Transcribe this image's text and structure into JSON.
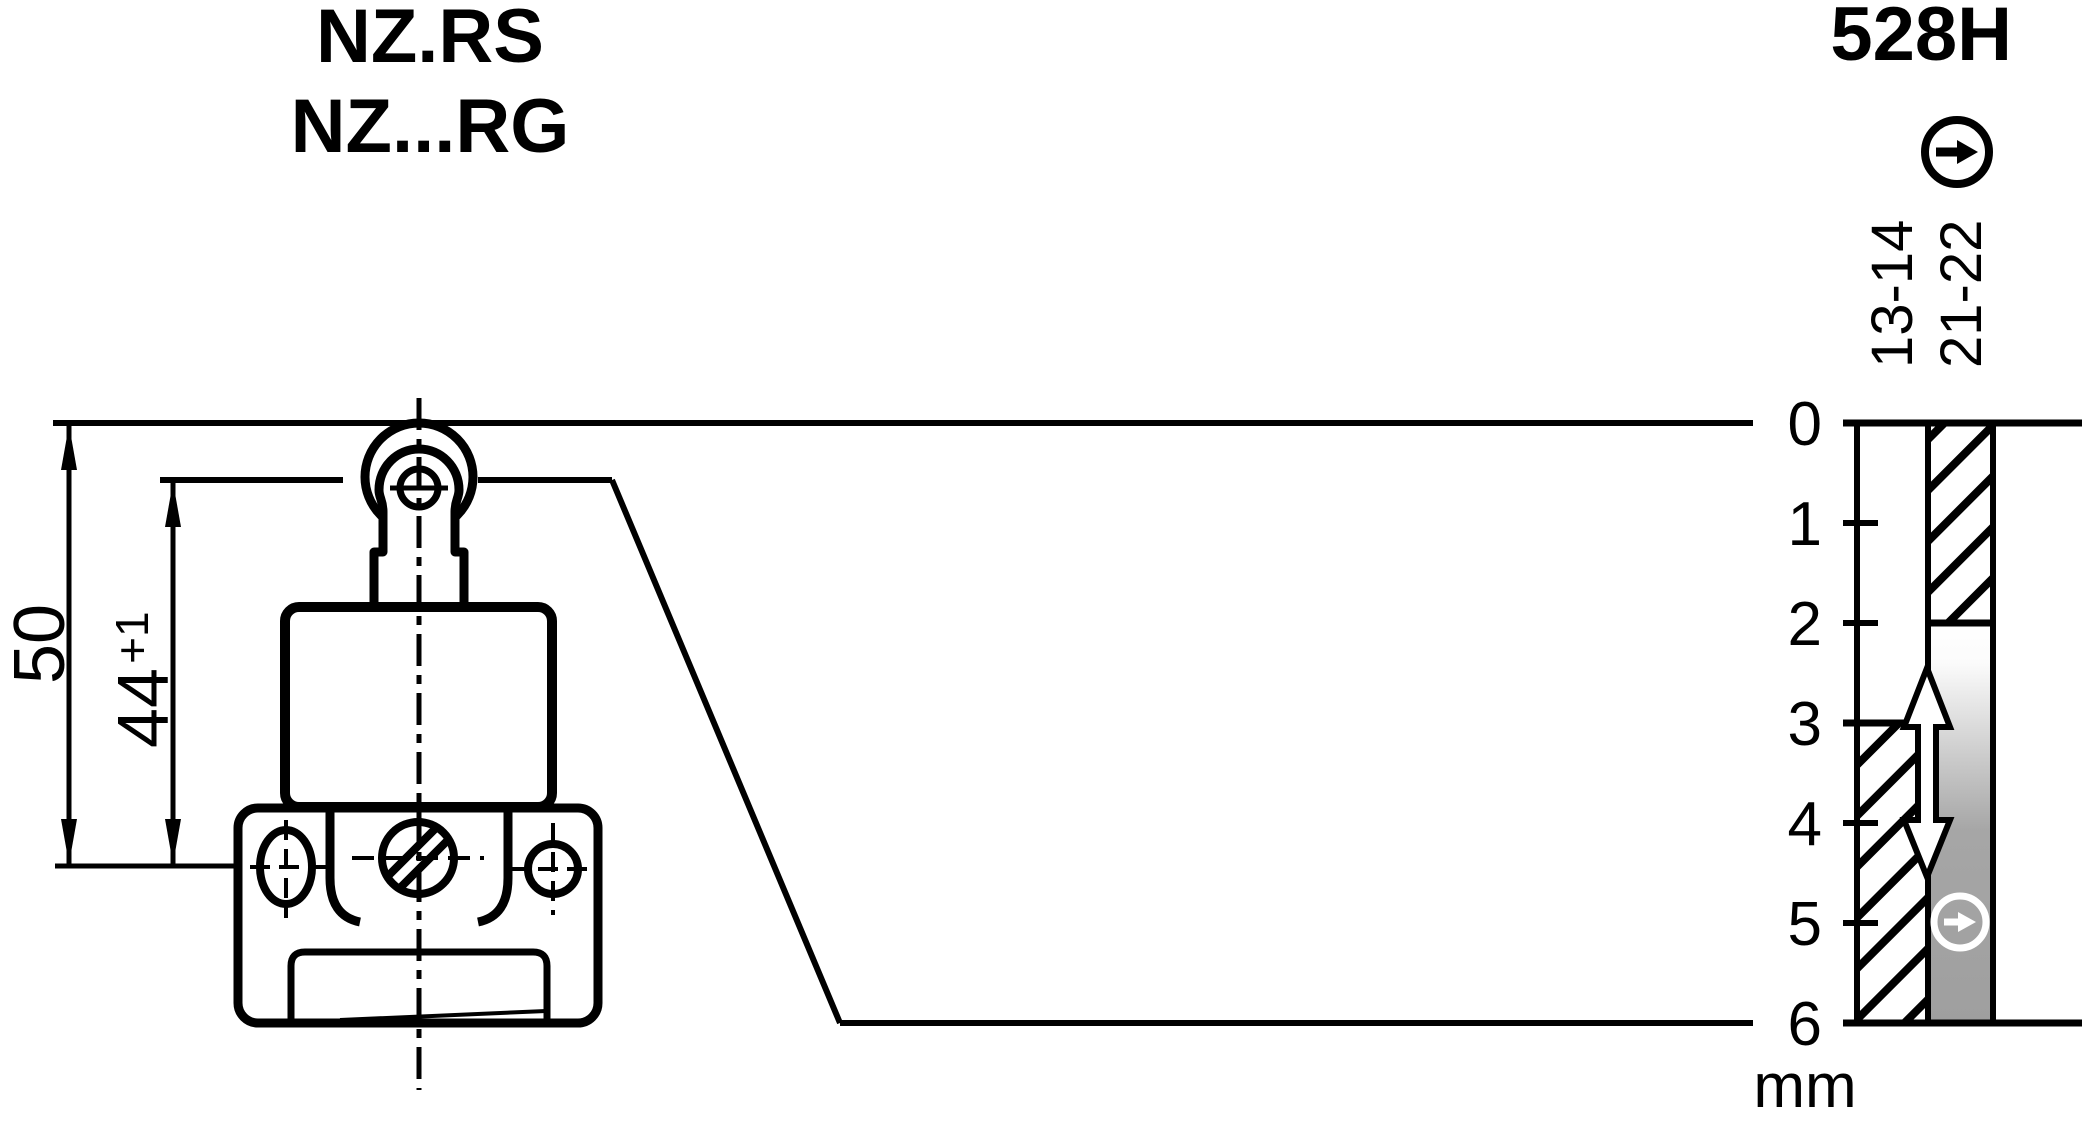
{
  "titles": {
    "product_series_line1": "NZ.RS",
    "product_series_line2": "NZ...RG",
    "diagram_code": "528H"
  },
  "dimensions": {
    "overall_height": "50",
    "actuation_height": "44",
    "actuation_tolerance": "+1"
  },
  "travel_diagram": {
    "unit": "mm",
    "ticks": [
      "0",
      "1",
      "2",
      "3",
      "4",
      "5",
      "6"
    ],
    "contact_columns": [
      {
        "label": "13-14",
        "closed_from_mm": 3,
        "closed_to_mm": 6
      },
      {
        "label": "21-22",
        "closed_from_mm": 0,
        "closed_to_mm": 2
      }
    ],
    "axis_range_mm": [
      0,
      6
    ],
    "icons": [
      "arrow-right-circle-icon",
      "arrow-right-circle-icon",
      "double-vertical-arrow"
    ],
    "colors": {
      "ink": "#000000",
      "paper": "#ffffff",
      "gray": "#a0a0a0"
    }
  }
}
